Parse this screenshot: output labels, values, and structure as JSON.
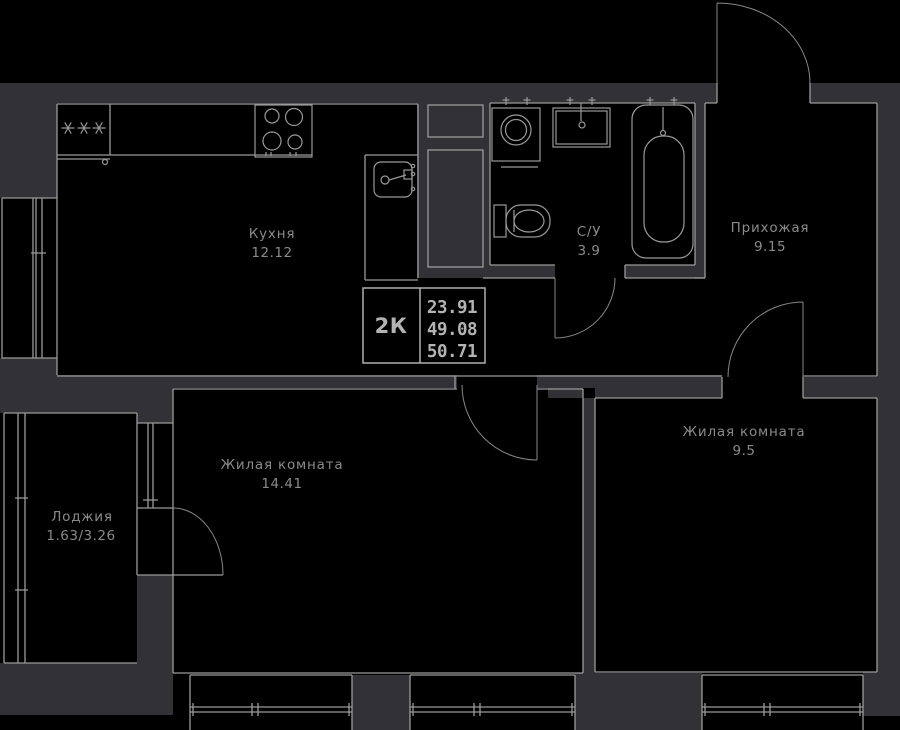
{
  "plan": {
    "rooms": {
      "kitchen": {
        "name": "Кухня",
        "area": "12.12"
      },
      "bathroom": {
        "name": "С/У",
        "area": "3.9"
      },
      "hallway": {
        "name": "Прихожая",
        "area": "9.15"
      },
      "living_room_1": {
        "name": "Жилая комната",
        "area": "14.41"
      },
      "living_room_2": {
        "name": "Жилая комната",
        "area": "9.5"
      },
      "loggia": {
        "name": "Лоджия",
        "area": "1.63/3.26"
      }
    },
    "info_box": {
      "plan_type": "2К",
      "values": [
        "23.91",
        "49.08",
        "50.71"
      ]
    },
    "colors": {
      "background": "#000000",
      "wall": "#323236",
      "line": "#9a9a9a",
      "bright_line": "#b0b0b0",
      "label_text": "#8a8a8a"
    }
  }
}
